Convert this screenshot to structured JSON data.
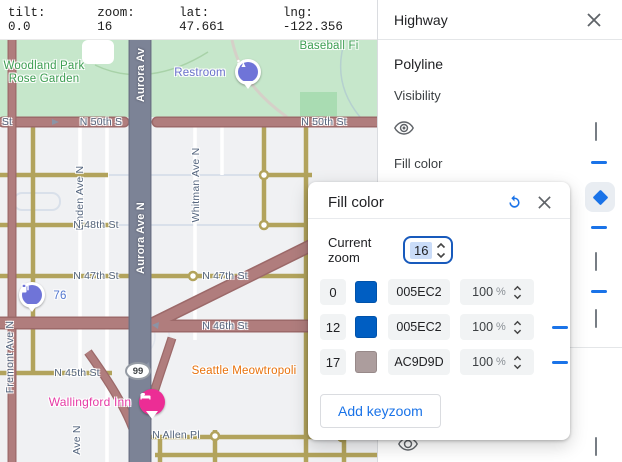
{
  "topbar": {
    "tilt": "tilt: 0.0",
    "zoom": "zoom: 16",
    "lat": "lat: 47.661",
    "lng": "lng: -122.356"
  },
  "panel": {
    "title": "Highway",
    "section_label": "Polyline",
    "visibility_label": "Visibility",
    "fill_color_label": "Fill color"
  },
  "dialog": {
    "title": "Fill color",
    "current_zoom_label": "Current zoom",
    "current_zoom_value": "16",
    "opacity_suffix": "%",
    "rows": [
      {
        "zoom": "0",
        "hex": "005EC2",
        "color": "#005EC2",
        "opacity": "100"
      },
      {
        "zoom": "12",
        "hex": "005EC2",
        "color": "#005EC2",
        "opacity": "100"
      },
      {
        "zoom": "17",
        "hex": "AC9D9D",
        "color": "#AC9D9D",
        "opacity": "100"
      }
    ],
    "add_button": "Add keyzoom"
  },
  "map": {
    "labels": {
      "woodland": "Woodland Park Rose Garden",
      "restroom": "Restroom",
      "baseball": "Baseball Fi",
      "st_edge": "St",
      "n50_left": "N 50th S",
      "n50_right": "N 50th St",
      "linden": "Linden Ave N",
      "aurora_top": "Aurora Av",
      "aurora_mid": "Aurora Ave N",
      "whitman": "Whitman Ave N",
      "n48": "N 48th St",
      "n47_left": "N 47th St",
      "n47_right": "N 47th St",
      "n46": "N 46th St",
      "n45": "N 45th St",
      "gas": "76",
      "shield": "99",
      "meow": "Seattle Meowtropoli",
      "wallingford": "Wallingford Inn",
      "allen": "N Allen Pl",
      "fremont": "Fremont Ave N",
      "ave_n": "Ave N"
    }
  },
  "theme": {
    "bg": "#f0f1f3",
    "park": "#c6e7cb",
    "park-dark": "#a9dcb2",
    "highway": "#b07d7d",
    "highway-casing": "#9c6969",
    "arterial": "#b2a35c",
    "aurora": "#7c8396",
    "white-road": "#ffffff",
    "faint": "#d9e0ea",
    "label": "#54657e",
    "green-label": "#3d9e52",
    "orange": "#e8710a",
    "pink": "#e63ba5",
    "poi-purple": "#6f74d8",
    "blue": "#1a73e8",
    "keyzoom-blue": "#005EC2",
    "keyzoom-mauve": "#AC9D9D"
  }
}
